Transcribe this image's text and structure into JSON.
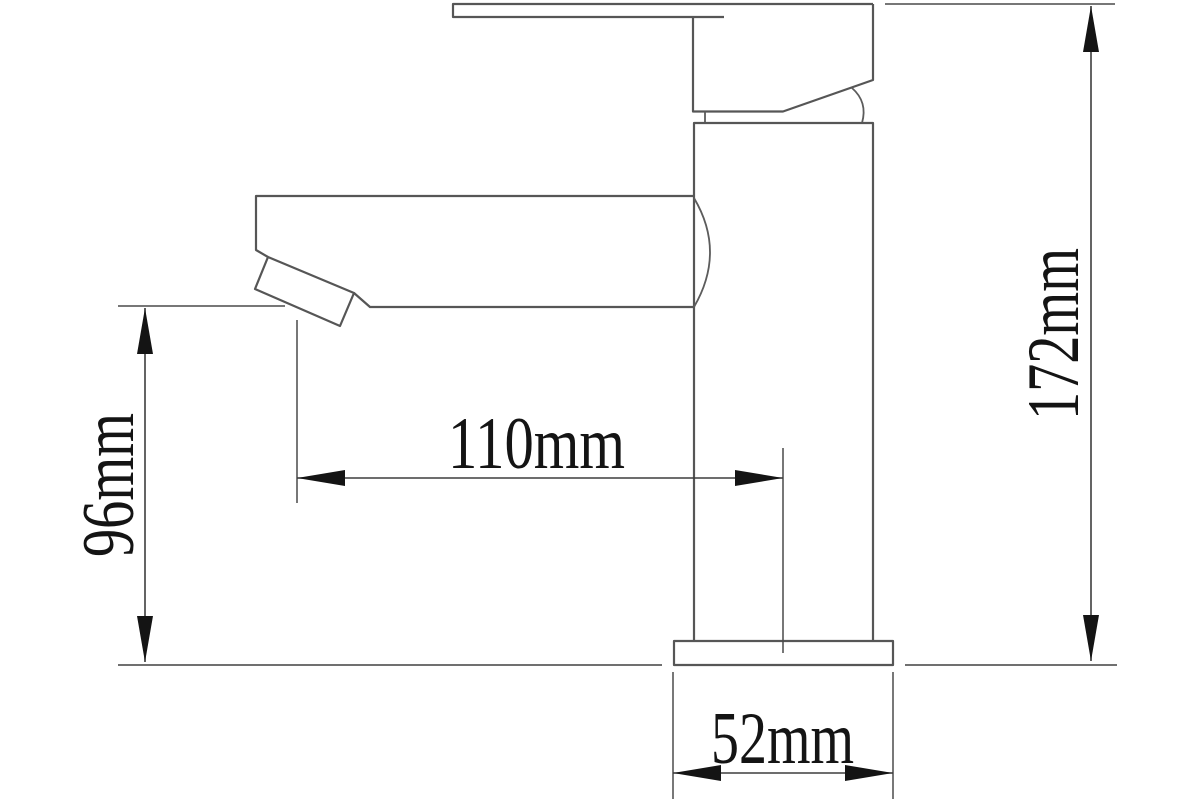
{
  "diagram": {
    "type": "technical-drawing",
    "subject": "single-lever basin mixer tap, side elevation with dimensions",
    "background_color": "#ffffff",
    "outline_color": "#565656",
    "dimension_line_color": "#3d3d3d",
    "text_color": "#141414",
    "dimensions": {
      "spout_outlet_height": {
        "label": "96mm",
        "orientation": "vertical-left"
      },
      "spout_reach": {
        "label": "110mm",
        "orientation": "horizontal"
      },
      "total_height": {
        "label": "172mm",
        "orientation": "vertical-right"
      },
      "base_width": {
        "label": "52mm",
        "orientation": "horizontal-bottom"
      }
    }
  }
}
